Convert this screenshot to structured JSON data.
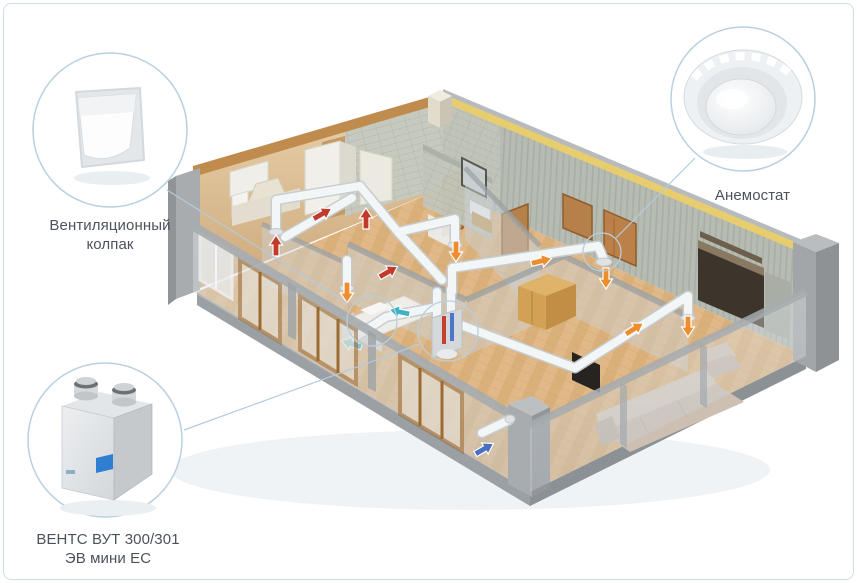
{
  "callouts": {
    "vent_cap": {
      "label_line1": "Вентиляционный",
      "label_line2": "колпак"
    },
    "anemostat": {
      "label": "Анемостат"
    },
    "hrv_unit": {
      "label_line1": "ВЕНТС ВУТ 300/301",
      "label_line2": "ЭВ мини ЕС"
    }
  },
  "airflow_colors": {
    "exhaust_red": "#c23a2c",
    "supply_orange": "#ee8d2e",
    "extract_teal": "#3fb3c4",
    "intake_blue": "#4a70c2"
  },
  "style_colors": {
    "page_border": "#cfdde6",
    "callout_circle_stroke": "#b9d0e0",
    "leader_line": "#b3cbdd",
    "label_text": "#4c525c"
  }
}
